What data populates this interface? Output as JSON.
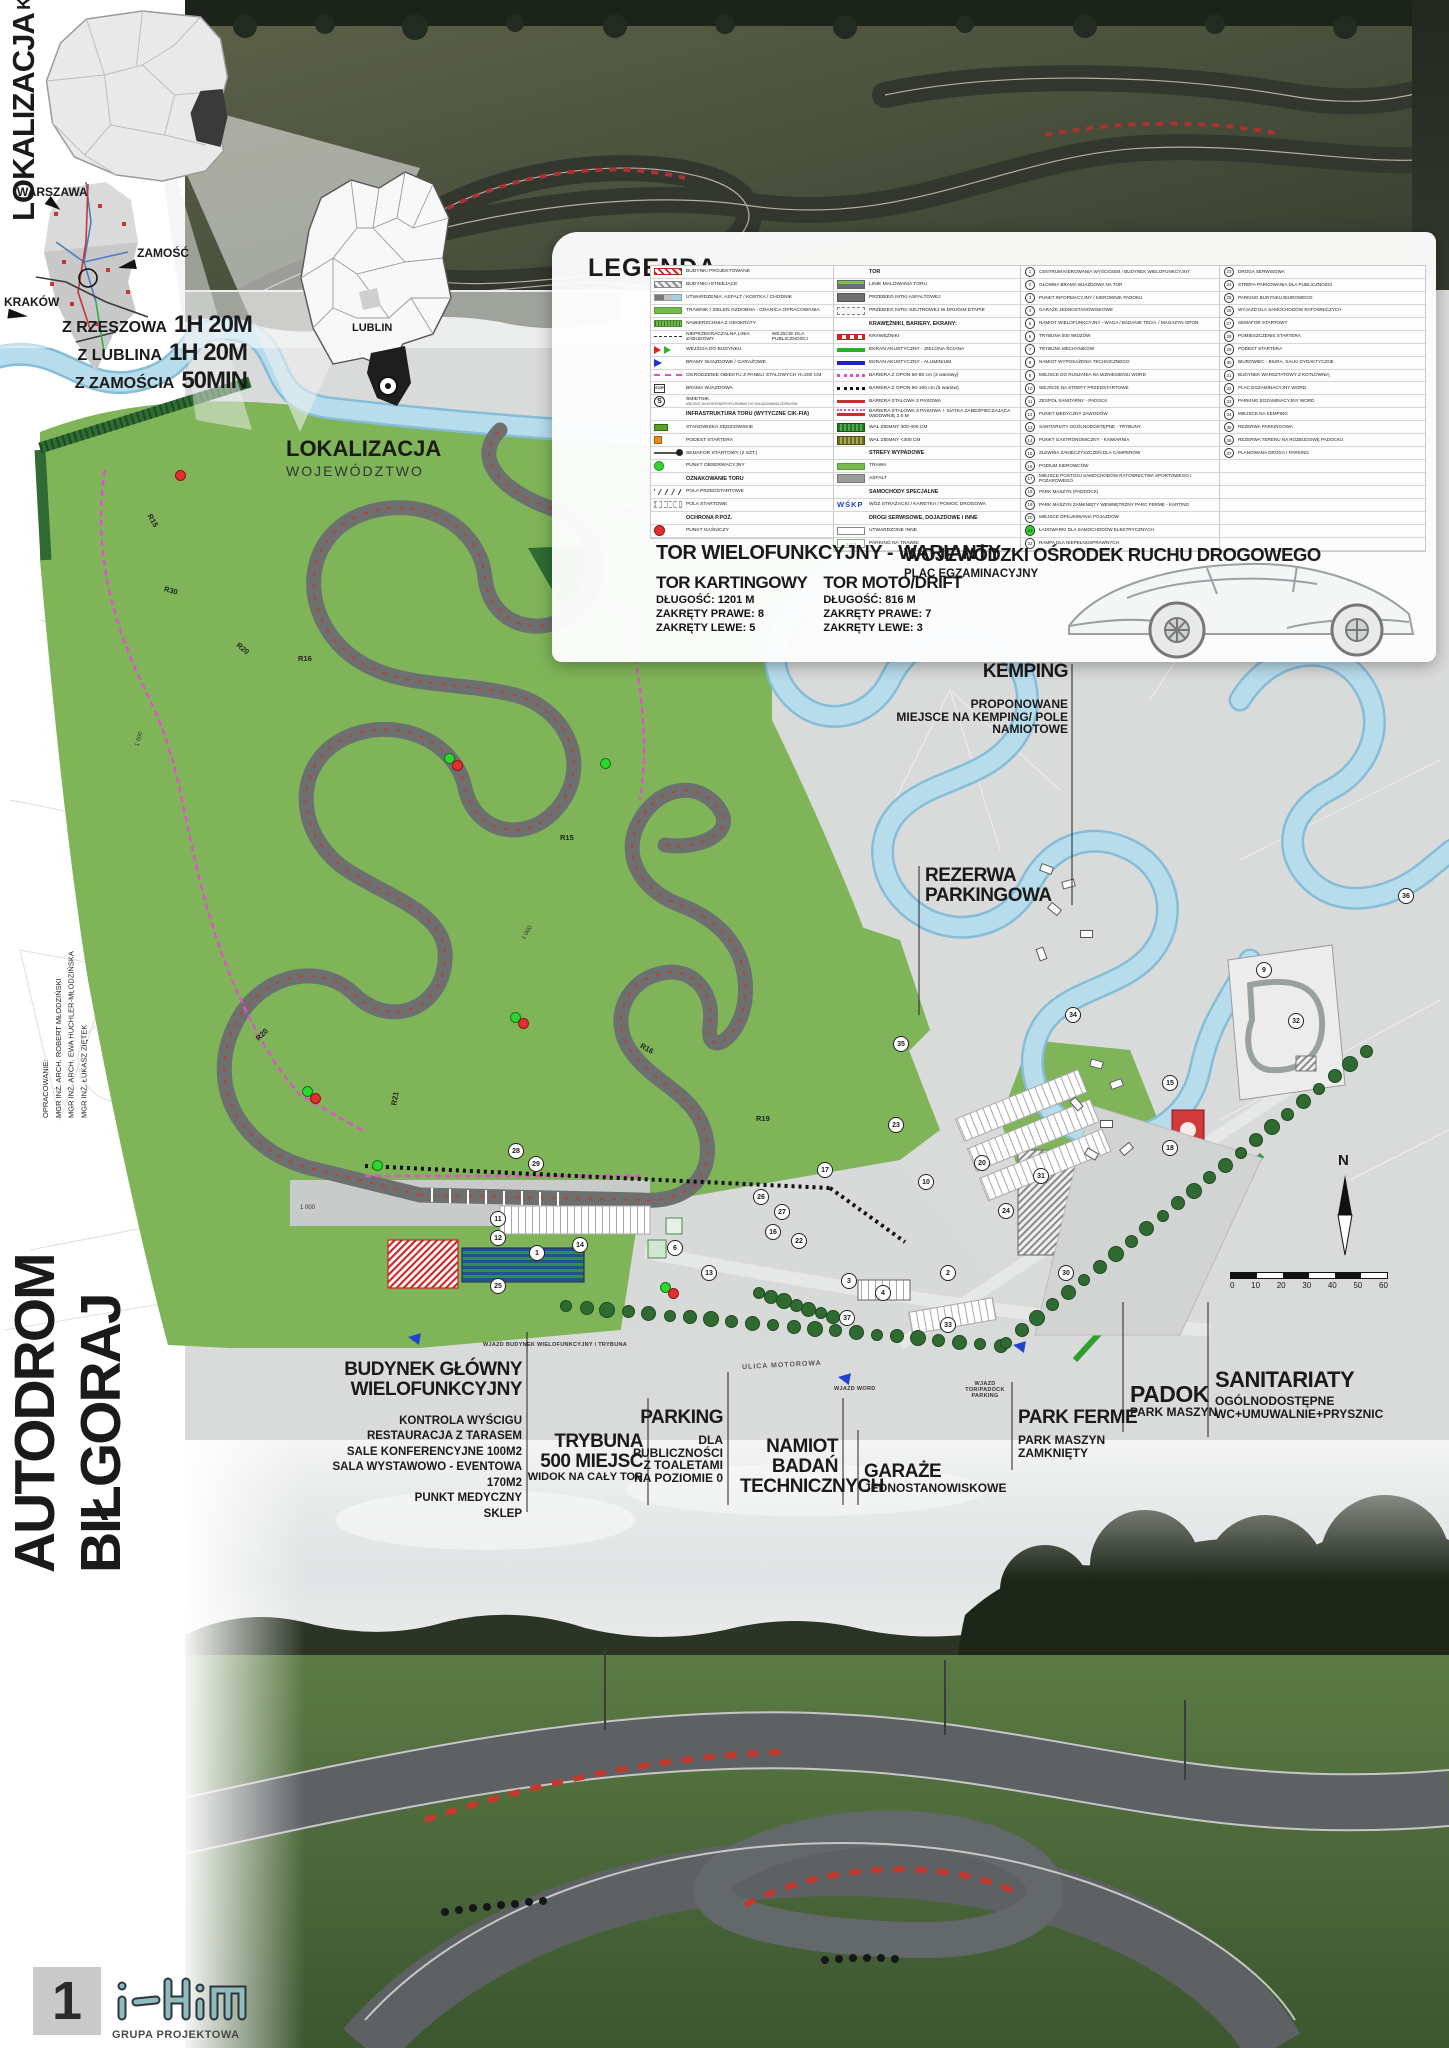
{
  "colors": {
    "site_green": "#7fb558",
    "river_blue": "#b7dcec",
    "track_gray": "#6e7070",
    "accent_red": "#cc2a2a",
    "fence_magenta": "#e44fd0",
    "logo_teal": "#8fbcba"
  },
  "poster": {
    "sheet_number": "1",
    "logo": {
      "mark": "iHim",
      "subtitle": "GRUPA PROJEKTOWA"
    },
    "title_vertical": "AUTODROM BIŁGORAJ",
    "credits": {
      "heading": "OPRACOWANIE:",
      "authors": [
        "MGR INŻ. ARCH. ROBERT MŁODZIŃSKI",
        "MGR INŻ. ARCH. EWA HUCHLER-MŁODZIŃSKA",
        "MGR INŻ. ŁUKASZ ZIĘTEK"
      ]
    }
  },
  "location_country": {
    "title": "LOKALIZACJA",
    "subtitle": "KRAJ",
    "cities": {
      "warszawa": "WARSZAWA",
      "zamosc": "ZAMOŚĆ",
      "krakow": "KRAKÓW"
    },
    "travel_times": [
      {
        "from": "Z RZESZOWA",
        "time": "1H 20M"
      },
      {
        "from": "Z LUBLINA",
        "time": "1H 20M"
      },
      {
        "from": "Z ZAMOŚCIA",
        "time": "50MIN"
      }
    ]
  },
  "location_region": {
    "title": "LOKALIZACJA",
    "subtitle": "WOJEWÓDZTWO",
    "label": "LUBLIN"
  },
  "legend": {
    "title": "LEGENDA",
    "col1": [
      {
        "t": "i",
        "s": "hatch-red",
        "l": "BUDYNKI PROJEKTOWANE"
      },
      {
        "t": "i",
        "s": "hatch-gray",
        "l": "BUDYNKI ISTNIEJĄCE"
      },
      {
        "t": "i",
        "s": "paving",
        "l": "UTWARDZENIA: ASFALT / KOSTKA / CHODNIK"
      },
      {
        "t": "i",
        "s": "green",
        "l": "TRAWNIK / ZIELEŃ OZDOBNA - GRANICA OPRACOWANIA"
      },
      {
        "t": "i",
        "s": "geogrid",
        "l": "NAWIERZCHNIA Z GEOKRATY"
      },
      {
        "t": "i",
        "s": "buildline",
        "l": "NIEPRZEKRACZALNA LINIA ZABUDOWY",
        "l2": "WEJŚCIE DLA PUBLICZNOŚCI"
      },
      {
        "t": "i",
        "s": "entry",
        "l": "WEJŚCIA DO BUDYNKU"
      },
      {
        "t": "i",
        "s": "gate",
        "l": "BRAMY WJAZDOWE / GARAŻOWE"
      },
      {
        "t": "i",
        "s": "fence",
        "l": "OGRODZENIE OBIEKTU Z PANELI STALOWYCH H=200 CM"
      },
      {
        "t": "i",
        "s": "stop",
        "l": "BRAMA WJAZDOWA"
      },
      {
        "t": "i",
        "s": "smietnik",
        "l": "ŚMIETNIK",
        "sub": "MIEJSCE NA KONTENERY/POJEMNIKI DO SKŁADOWANIA ODPADÓW"
      },
      {
        "t": "h",
        "l": "INFRASTRUKTURA TORU (WYTYCZNE CIK-FIA)"
      },
      {
        "t": "i",
        "s": "judge",
        "l": "STANOWISKA SĘDZIOWSKIE"
      },
      {
        "t": "i",
        "s": "orange",
        "l": "PODEST STARTERA"
      },
      {
        "t": "i",
        "s": "semaphore",
        "l": "SEMAFOR STARTOWY (2 SZT.)"
      },
      {
        "t": "i",
        "s": "dot-green",
        "l": "PUNKT OBSERWACYJNY"
      },
      {
        "t": "h",
        "l": "OZNAKOWANIE TORU"
      },
      {
        "t": "i",
        "s": "prestart",
        "l": "POLA PRZEDSTARTOWE"
      },
      {
        "t": "i",
        "s": "startfield",
        "l": "POLA STARTOWE"
      },
      {
        "t": "h",
        "l": "OCHRONA P.POŻ."
      },
      {
        "t": "i",
        "s": "dot-red",
        "l": "PUNKT GAŚNICZY"
      }
    ],
    "col2": [
      {
        "t": "h",
        "l": "TOR"
      },
      {
        "t": "i",
        "s": "trackpaint",
        "l": "LINIE MALOWANIA TORU"
      },
      {
        "t": "i",
        "s": "asphalt",
        "l": "PRZEBIEG NITKI ASFALTOWEJ"
      },
      {
        "t": "i",
        "s": "gravel",
        "l": "PRZEBIEG NITKI SZUTROWEJ W DRUGIM ETAPIE"
      },
      {
        "t": "h",
        "l": "KRAWĘŻNIKI, BARIERY, EKRANY:"
      },
      {
        "t": "i",
        "s": "kerb",
        "l": "KRAWĘŻNIKI"
      },
      {
        "t": "i",
        "s": "ekran-green",
        "l": "EKRAN AKUSTYCZNY - ZIELONA ŚCIANA"
      },
      {
        "t": "i",
        "s": "ekran-blue",
        "l": "EKRAN AKUSTYCZNY - ALUMINIUM"
      },
      {
        "t": "i",
        "s": "tires-pink",
        "l": "BARIERA Z OPON 50-80 cm (3 warstwy)"
      },
      {
        "t": "i",
        "s": "tires-black",
        "l": "BARIERA Z OPON 90-100 cm (5 warstw)"
      },
      {
        "t": "i",
        "s": "steel",
        "l": "BARIERA STALOWA 3 PASOWA"
      },
      {
        "t": "i",
        "s": "steel-net",
        "l": "BARIERA STALOWA 3 PASOWA + SIATKA ZABEZPIECZAJĄCA WIDOWNIĘ 2.5 M"
      },
      {
        "t": "i",
        "s": "wal-green",
        "l": "WAŁ ZIEMNY 300-400 CM"
      },
      {
        "t": "i",
        "s": "wal-olive",
        "l": "WAŁ ZIEMNY <300 CM"
      },
      {
        "t": "h",
        "l": "STREFY WYPADOWE"
      },
      {
        "t": "i",
        "s": "green",
        "l": "TRAWA"
      },
      {
        "t": "i",
        "s": "gray",
        "l": "ASFALT"
      },
      {
        "t": "h",
        "l": "SAMOCHODY SPECJALNE"
      },
      {
        "t": "i",
        "s": "wskp",
        "l": "WÓZ STRAŻACKI / KARETKA / POMOC DROGOWA",
        "mark": "WŚKP"
      },
      {
        "t": "h",
        "l": "DROGI SERWISOWE, DOJAZDOWE I INNE"
      },
      {
        "t": "i",
        "s": "white",
        "l": "UTWARDZONE INNE"
      },
      {
        "t": "i",
        "s": "grasspark",
        "l": "PARKING NA TRAWIE",
        "mark": "1 2 3"
      }
    ],
    "numbered": [
      {
        "n": "1",
        "l": "CENTRUM KIEROWANIA WYŚCIGIEM / BUDYNEK WIELOFUNKCYJNY"
      },
      {
        "n": "2",
        "l": "GŁÓWNA BRAMA WJAZDOWA NA TOR"
      },
      {
        "n": "3",
        "l": "PUNKT INFORMACYJNY / KIEROWNIK PADOKU"
      },
      {
        "n": "4",
        "l": "GARAŻE JEDNOSTANOWISKOWE"
      },
      {
        "n": "5",
        "l": "NAMIOT WIELOFUNKCYJNY - WAGA / BADANIE TECH. / MAGAZYN OPON"
      },
      {
        "n": "6",
        "l": "TRYBUNA 500 WIDZÓW"
      },
      {
        "n": "7",
        "l": "TRYBUNA MECHANIKÓW"
      },
      {
        "n": "8",
        "l": "NAMIOT WYPOSAŻENIA TECHNICZNEGO"
      },
      {
        "n": "9",
        "l": "MIEJSCE DO RUSZANIA NA WZNIESIENIU WORD"
      },
      {
        "n": "10",
        "l": "WEJŚCIE NA STREFY PRZEDSTARTOWE"
      },
      {
        "n": "11",
        "l": "ZESPÓŁ SANITARNY - PADOCK"
      },
      {
        "n": "12",
        "l": "PUNKT MEDYCZNY ZAWODÓW"
      },
      {
        "n": "13",
        "l": "SANITARIATY OGÓLNODOSTĘPNE - TRYBUNY"
      },
      {
        "n": "14",
        "l": "PUNKT GASTRONOMICZNY - KAWIARNIA"
      },
      {
        "n": "15",
        "l": "ZLEWNIA ZANIECZYSZCZEŃ DLA CAMPERÓW"
      },
      {
        "n": "16",
        "l": "PODIUM KIEROWCÓW"
      },
      {
        "n": "17",
        "l": "MIEJSCE POSTOJU SAMOCHODÓW RATOWNICTWA SPORTOWEGO I POŻAROWEGO"
      },
      {
        "n": "18",
        "l": "PARK MASZYN (PADDOCK)"
      },
      {
        "n": "19",
        "l": "PARK MASZYN ZAMKNIĘTY WEWNĘTRZNY PARC FERME - KARTING"
      },
      {
        "n": "20",
        "l": "MIEJSCE OPŁUKIWANIA POJAZDÓW"
      },
      {
        "n": "21",
        "l": "ŁADOWARKI DLA SAMOCHODÓW ELEKTRYCZNYCH",
        "green": true
      },
      {
        "n": "22",
        "l": "RAMPA DLA NIEPEŁNOSPRAWNYCH"
      },
      {
        "n": "23",
        "l": "DROGA SERWISOWA"
      },
      {
        "n": "24",
        "l": "STREFA PARKOWANIA DLA PUBLICZNOŚCI"
      },
      {
        "n": "25",
        "l": "PARKING BUDYNKU BIUROWEGO"
      },
      {
        "n": "26",
        "l": "WYJAZD DLA SAMOCHODÓW RATOWNICZYCH"
      },
      {
        "n": "27",
        "l": "SEMAFOR STARTOWY"
      },
      {
        "n": "28",
        "l": "POMIESZCZENIE STARTERA"
      },
      {
        "n": "29",
        "l": "PODEST STARTERA"
      },
      {
        "n": "30",
        "l": "BIUROWIEC - BIURA, SALKI DYDAKTYCZNE"
      },
      {
        "n": "31",
        "l": "BUDYNEK WARSZTATOWY Z KOTŁOWNIĄ"
      },
      {
        "n": "32",
        "l": "PLAC EGZAMINACYJNY WORD"
      },
      {
        "n": "33",
        "l": "PARKING EGZAMINACYJNY WORD"
      },
      {
        "n": "34",
        "l": "MIEJSCE NA KEMPING"
      },
      {
        "n": "35",
        "l": "REZERWA PARKINGOWA"
      },
      {
        "n": "36",
        "l": "REZERWA TERENU NA ROZBUDOWĘ PADOCKU"
      },
      {
        "n": "37",
        "l": "PLANOWANA DROGA I PARKING"
      }
    ]
  },
  "variants": {
    "title": "TOR WIELOFUNKCYJNY - WARIANTY",
    "options": [
      {
        "name": "TOR KARTINGOWY",
        "length": "DŁUGOŚĆ: 1201 M",
        "right": "ZAKRĘTY PRAWE: 8",
        "left": "ZAKRĘTY LEWE: 5"
      },
      {
        "name": "TOR MOTO/DRIFT",
        "length": "DŁUGOŚĆ: 816 M",
        "right": "ZAKRĘTY PRAWE: 7",
        "left": "ZAKRĘTY LEWE: 3"
      }
    ]
  },
  "word": {
    "title": "WOJEWÓDZKI OŚRODEK RUCHU DROGOWEGO",
    "subtitle": "PLAC EGZAMINACYJNY"
  },
  "plan": {
    "kemping": {
      "title": "KEMPING",
      "sub1": "PROPONOWANE",
      "sub2": "MIEJSCE NA KEMPING/ POLE NAMIOTOWE"
    },
    "rezerwa": {
      "line1": "REZERWA",
      "line2": "PARKINGOWA"
    },
    "budynek": {
      "line1": "BUDYNEK GŁÓWNY",
      "line2": "WIELOFUNKCYJNY",
      "items": [
        "KONTROLA WYŚCIGU",
        "RESTAURACJA Z TARASEM",
        "SALE KONFERENCYJNE 100M2",
        "SALA WYSTAWOWO - EVENTOWA 170M2",
        "PUNKT MEDYCZNY",
        "SKLEP"
      ]
    },
    "trybuna": {
      "line1": "TRYBUNA",
      "line2": "500 MIEJSC",
      "line3": "WIDOK NA CAŁY TOR"
    },
    "parking": {
      "line1": "PARKING",
      "lines": [
        "DLA",
        "PUBLICZNOŚCI",
        "Z TOALETAMI",
        "NA POZIOMIE 0"
      ]
    },
    "namiot": {
      "lines": [
        "NAMIOT",
        "BADAŃ",
        "TECHNICZNYCH"
      ]
    },
    "garaze": {
      "line1": "GARAŻE",
      "line2": "JEDNOSTANOWISKOWE"
    },
    "park_ferme": {
      "line1": "PARK FERME",
      "line2": "PARK MASZYN",
      "line3": "ZAMKNIĘTY"
    },
    "padok": {
      "line1": "PADOK",
      "line2": "PARK MASZYN"
    },
    "sanitariaty": {
      "line1": "SANITARIATY",
      "line2": "OGÓLNODOSTĘPNE",
      "line3": "WC+UMUWALNIE+PRYSZNIC"
    },
    "street": "ULICA MOTOROWA",
    "entries": [
      "WJAZD BUDYNEK WIELOFUNKCYJNY / TRYBUNA",
      "WJAZD TOR/PADOCK PARKING",
      "WJAZD WORD"
    ],
    "compass": "N",
    "scale_ticks": [
      "0",
      "10",
      "20",
      "30",
      "40",
      "50",
      "60"
    ],
    "dimension_label": "1 000",
    "radii": [
      {
        "t": "R15",
        "x": 618,
        "y": 508,
        "r": -30
      },
      {
        "t": "R30",
        "x": 164,
        "y": 586,
        "r": 15
      },
      {
        "t": "R20",
        "x": 236,
        "y": 644,
        "r": 40
      },
      {
        "t": "R16",
        "x": 298,
        "y": 654,
        "r": 0
      },
      {
        "t": "R15",
        "x": 146,
        "y": 516,
        "r": 60
      },
      {
        "t": "R20",
        "x": 255,
        "y": 1030,
        "r": -45
      },
      {
        "t": "R21",
        "x": 388,
        "y": 1094,
        "r": -80
      },
      {
        "t": "R15",
        "x": 560,
        "y": 833,
        "r": 0
      },
      {
        "t": "R19",
        "x": 756,
        "y": 1114,
        "r": 0
      },
      {
        "t": "R16",
        "x": 640,
        "y": 1044,
        "r": 30
      }
    ],
    "markers": [
      {
        "n": "1",
        "x": 536,
        "y": 1252
      },
      {
        "n": "2",
        "x": 947,
        "y": 1272
      },
      {
        "n": "3",
        "x": 848,
        "y": 1280
      },
      {
        "n": "4",
        "x": 882,
        "y": 1292
      },
      {
        "n": "6",
        "x": 674,
        "y": 1247
      },
      {
        "n": "9",
        "x": 1263,
        "y": 969
      },
      {
        "n": "10",
        "x": 925,
        "y": 1181
      },
      {
        "n": "11",
        "x": 497,
        "y": 1218
      },
      {
        "n": "12",
        "x": 497,
        "y": 1237
      },
      {
        "n": "13",
        "x": 708,
        "y": 1272
      },
      {
        "n": "14",
        "x": 579,
        "y": 1244
      },
      {
        "n": "15",
        "x": 1169,
        "y": 1082
      },
      {
        "n": "16",
        "x": 772,
        "y": 1231
      },
      {
        "n": "17",
        "x": 824,
        "y": 1169
      },
      {
        "n": "18",
        "x": 1169,
        "y": 1147
      },
      {
        "n": "20",
        "x": 981,
        "y": 1162
      },
      {
        "n": "22",
        "x": 798,
        "y": 1240
      },
      {
        "n": "23",
        "x": 895,
        "y": 1124
      },
      {
        "n": "24",
        "x": 1005,
        "y": 1210
      },
      {
        "n": "25",
        "x": 497,
        "y": 1285
      },
      {
        "n": "26",
        "x": 760,
        "y": 1196
      },
      {
        "n": "27",
        "x": 781,
        "y": 1211
      },
      {
        "n": "28",
        "x": 515,
        "y": 1150
      },
      {
        "n": "29",
        "x": 535,
        "y": 1163
      },
      {
        "n": "30",
        "x": 1065,
        "y": 1272
      },
      {
        "n": "31",
        "x": 1040,
        "y": 1175
      },
      {
        "n": "32",
        "x": 1295,
        "y": 1020
      },
      {
        "n": "33",
        "x": 947,
        "y": 1324
      },
      {
        "n": "34",
        "x": 1072,
        "y": 1014
      },
      {
        "n": "35",
        "x": 900,
        "y": 1043
      },
      {
        "n": "36",
        "x": 1405,
        "y": 895
      },
      {
        "n": "37",
        "x": 846,
        "y": 1317
      }
    ]
  }
}
